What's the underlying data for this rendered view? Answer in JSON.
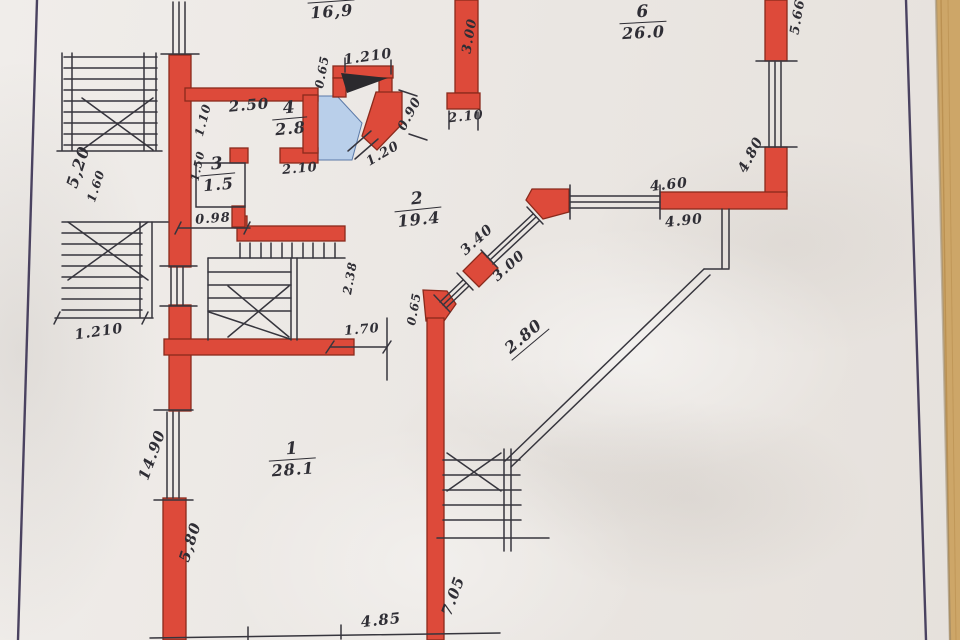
{
  "meta": {
    "title": "hand-drawn floor plan (photograph)",
    "drawing_type": "floor plan with red masonry walls, stairs and dimension chains",
    "decimal_style": "mixed comma/point handwriting"
  },
  "colors": {
    "paper": "#ebe7e3",
    "wall_red": "#dd4a3a",
    "wall_outline": "#8a2a1c",
    "ink": "#36353d",
    "blue_floor": "#b9cfea",
    "blue_floor_edge": "#5b79a8",
    "soot_black": "#2b2a2e",
    "frame_line": "#4a4260",
    "wood_table": "#cda668",
    "wood_grain": "#b4894a"
  },
  "rooms": [
    {
      "number": "",
      "area": "16,9",
      "x": 331,
      "y": 1,
      "rot": -4,
      "cut_top": true
    },
    {
      "number": "6",
      "area": "26.0",
      "x": 642,
      "y": 4,
      "rot": -3,
      "cut_top": false
    },
    {
      "number": "4",
      "area": "2.8",
      "x": 288,
      "y": 100,
      "rot": -5,
      "cut_top": false
    },
    {
      "number": "3",
      "area": "1.5",
      "x": 216,
      "y": 156,
      "rot": -5,
      "cut_top": false
    },
    {
      "number": "2",
      "area": "19.4",
      "x": 416,
      "y": 191,
      "rot": -6,
      "cut_top": false
    },
    {
      "number": "1",
      "area": "28.1",
      "x": 291,
      "y": 441,
      "rot": -4,
      "cut_top": false
    }
  ],
  "dimensions": [
    {
      "text": "5,20",
      "x": 78,
      "y": 167,
      "rot": -72,
      "size": 16,
      "underline": false
    },
    {
      "text": "1.60",
      "x": 96,
      "y": 186,
      "rot": -72,
      "size": 12,
      "underline": false
    },
    {
      "text": "1.210",
      "x": 99,
      "y": 332,
      "rot": -8,
      "size": 14,
      "underline": false
    },
    {
      "text": "1.10",
      "x": 203,
      "y": 120,
      "rot": -75,
      "size": 12,
      "underline": false
    },
    {
      "text": "2.50",
      "x": 249,
      "y": 105,
      "rot": -5,
      "size": 15,
      "underline": false
    },
    {
      "text": "2.10",
      "x": 300,
      "y": 169,
      "rot": -5,
      "size": 13,
      "underline": false
    },
    {
      "text": "1.50",
      "x": 198,
      "y": 166,
      "rot": -78,
      "size": 11,
      "underline": false
    },
    {
      "text": "0.98",
      "x": 213,
      "y": 219,
      "rot": -4,
      "size": 13,
      "underline": false
    },
    {
      "text": "0.65",
      "x": 322,
      "y": 72,
      "rot": -80,
      "size": 12,
      "underline": false
    },
    {
      "text": "1.210",
      "x": 368,
      "y": 57,
      "rot": -8,
      "size": 14,
      "underline": false
    },
    {
      "text": "0.90",
      "x": 410,
      "y": 114,
      "rot": -62,
      "size": 13,
      "underline": false
    },
    {
      "text": "1.20",
      "x": 383,
      "y": 154,
      "rot": -30,
      "size": 13,
      "underline": false
    },
    {
      "text": "3.00",
      "x": 470,
      "y": 36,
      "rot": -80,
      "size": 13,
      "underline": false
    },
    {
      "text": "2.10",
      "x": 466,
      "y": 117,
      "rot": -6,
      "size": 13,
      "underline": false
    },
    {
      "text": "5.66",
      "x": 798,
      "y": 17,
      "rot": -80,
      "size": 13,
      "underline": false
    },
    {
      "text": "4.80",
      "x": 751,
      "y": 155,
      "rot": -62,
      "size": 14,
      "underline": false
    },
    {
      "text": "4.60",
      "x": 669,
      "y": 185,
      "rot": -6,
      "size": 14,
      "underline": false
    },
    {
      "text": "4.90",
      "x": 684,
      "y": 221,
      "rot": -6,
      "size": 14,
      "underline": false
    },
    {
      "text": "3.40",
      "x": 477,
      "y": 240,
      "rot": -42,
      "size": 14,
      "underline": false
    },
    {
      "text": "3.00",
      "x": 509,
      "y": 266,
      "rot": -42,
      "size": 14,
      "underline": false
    },
    {
      "text": "2.80",
      "x": 524,
      "y": 337,
      "rot": -40,
      "size": 16,
      "underline": true
    },
    {
      "text": "2.38",
      "x": 350,
      "y": 278,
      "rot": -80,
      "size": 12,
      "underline": false
    },
    {
      "text": "0.65",
      "x": 414,
      "y": 309,
      "rot": -80,
      "size": 12,
      "underline": false
    },
    {
      "text": "1.70",
      "x": 362,
      "y": 330,
      "rot": -5,
      "size": 13,
      "underline": false
    },
    {
      "text": "14.90",
      "x": 152,
      "y": 455,
      "rot": -70,
      "size": 15,
      "underline": false
    },
    {
      "text": "5,80",
      "x": 190,
      "y": 542,
      "rot": -72,
      "size": 15,
      "underline": false
    },
    {
      "text": "7.05",
      "x": 453,
      "y": 596,
      "rot": -70,
      "size": 15,
      "underline": false
    },
    {
      "text": "4.85",
      "x": 381,
      "y": 620,
      "rot": -6,
      "size": 15,
      "underline": false
    }
  ]
}
